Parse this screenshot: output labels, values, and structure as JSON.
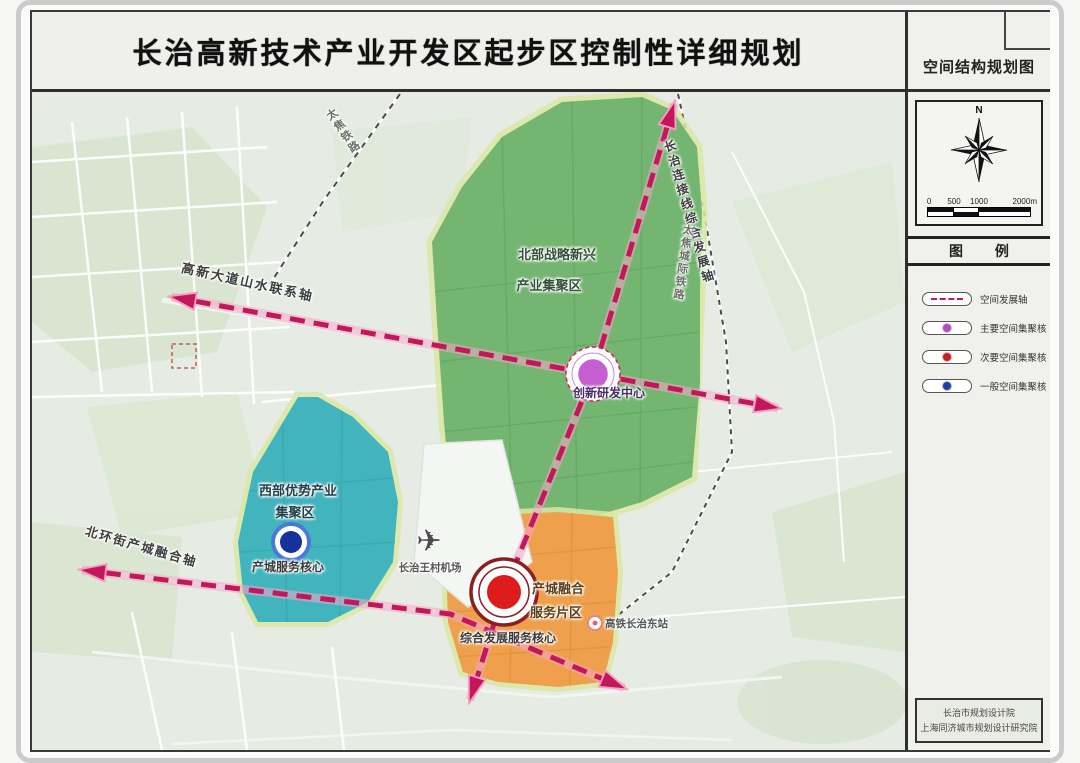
{
  "title": "长治高新技术产业开发区起步区控制性详细规划",
  "side_panel": {
    "map_name": "空间结构规划图",
    "compass_north": "N",
    "scale_ticks": [
      "0",
      "500",
      "1000",
      "2000m"
    ],
    "legend_title": "图 例",
    "legend_items": [
      {
        "symbol": "dashed-axis-line",
        "label": "空间发展轴"
      },
      {
        "symbol": "purple-dot",
        "label": "主要空间集聚核"
      },
      {
        "symbol": "red-dot",
        "label": "次要空间集聚核"
      },
      {
        "symbol": "blue-dot",
        "label": "一般空间集聚核"
      }
    ],
    "credits_line1": "长治市规划设计院",
    "credits_line2": "上海同济城市规划设计研究院"
  },
  "map": {
    "zones": {
      "north": {
        "line1": "北部战略新兴",
        "line2": "产业集聚区"
      },
      "west": {
        "line1": "西部优势产业",
        "line2": "集聚区",
        "core": "产城服务核心"
      },
      "southeast": {
        "line1": "产城融合",
        "line2": "服务片区",
        "core": "综合发展服务核心"
      }
    },
    "cores": {
      "innovation": "创新研发中心"
    },
    "axes": {
      "gaoxin": "高新大道山水联系轴",
      "beihuan": "北环街产城融合轴",
      "changzhi": "长治连接线综合发展轴"
    },
    "railways": {
      "taijiao": "太焦铁路",
      "taijiao_intercity": "太焦城际铁路"
    },
    "landmarks": {
      "airport": "长治王村机场",
      "hsr_station": "高铁长治东站",
      "airport_icon": "✈"
    }
  },
  "colors": {
    "axis_magenta": "#c2185b",
    "green_zone": "#74b671",
    "teal_zone": "#41b4bd",
    "orange_zone": "#efa04c",
    "purple_core": "#c45ed2",
    "red_core": "#dd1c1c",
    "blue_core": "#16309c"
  }
}
